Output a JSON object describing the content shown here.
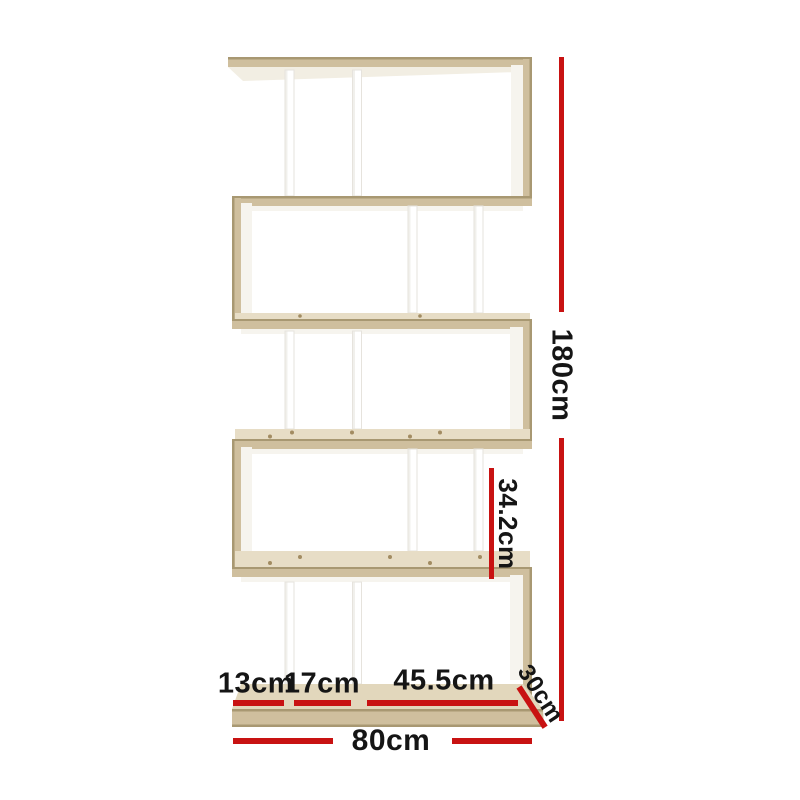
{
  "dimensions": {
    "height": "180cm",
    "tier_gap": "34.2cm",
    "section_left": "13cm",
    "section_middle": "17cm",
    "section_right": "45.5cm",
    "depth": "30cm",
    "width": "80cm"
  },
  "colors": {
    "background": "#ffffff",
    "dimension_line": "#c81212",
    "label_text": "#151515",
    "wood_edge": "#a89872",
    "wood_face": "#cfbf9e",
    "wood_top": "#e7ddc6",
    "wood_base_top": "#e2d7bc",
    "wood_underside": "#f2eee3",
    "interior_light": "#f6f4ee",
    "divider_white": "#ffffff",
    "divider_shade": "#e6e3dd",
    "hole_color": "#a28c62"
  }
}
